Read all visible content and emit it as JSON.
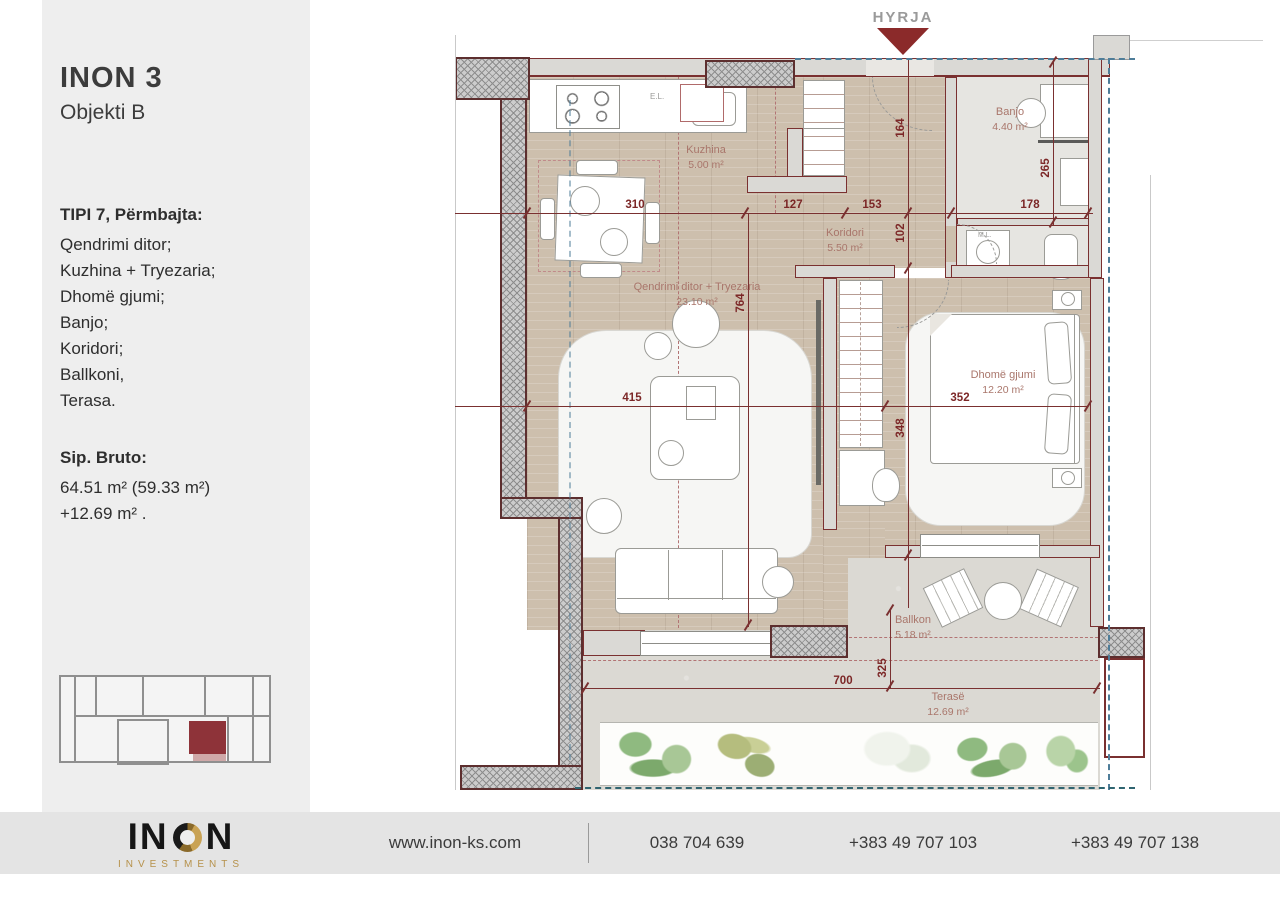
{
  "sidebar": {
    "title": "INON 3",
    "subtitle": "Objekti B",
    "section_heading": "TIPI 7, Përmbajta:",
    "rooms": [
      "Qendrimi ditor;",
      "Kuzhina + Tryezaria;",
      "Dhomë gjumi;",
      "Banjo;",
      "Koridori;",
      "Ballkoni,",
      "Terasa."
    ],
    "area_heading": "Sip. Bruto:",
    "area_line1": "64.51 m² (59.33 m²)",
    "area_line2": "+12.69 m² ."
  },
  "plan": {
    "entry_label": "HYRJA",
    "labels": {
      "electrical": "E.L.",
      "washing_machine": "M.L."
    },
    "rooms": [
      {
        "name": "Kuzhina",
        "area": "5.00 m²"
      },
      {
        "name": "Koridori",
        "area": "5.50 m²"
      },
      {
        "name": "Banjo",
        "area": "4.40 m²"
      },
      {
        "name": "Qendrimi ditor + Tryezaria",
        "area": "23.10 m²"
      },
      {
        "name": "Dhomë gjumi",
        "area": "12.20 m²"
      },
      {
        "name": "Ballkon",
        "area": "5.18 m²"
      },
      {
        "name": "Terasë",
        "area": "12.69 m²"
      }
    ],
    "dims": {
      "d310": "310",
      "d127": "127",
      "d153": "153",
      "d178": "178",
      "d415": "415",
      "d352": "352",
      "d764": "764",
      "d164": "164",
      "d102": "102",
      "d348": "348",
      "d265": "265",
      "d325": "325",
      "d700": "700"
    }
  },
  "minimap": {
    "highlight_color": "#8e3339",
    "terrace_color": "#cfa8a8"
  },
  "footer": {
    "logo": {
      "left": "IN",
      "right": "N",
      "sub": "INVESTMENTS"
    },
    "website": "www.inon-ks.com",
    "phone1": "038 704 639",
    "phone2": "+383 49 707 103",
    "phone3": "+383 49 707 138"
  },
  "colors": {
    "wall_accent": "#7a3030",
    "entry_arrow": "#8b2a2a",
    "facade_line": "#4e7d99",
    "gold": "#b6914a"
  }
}
